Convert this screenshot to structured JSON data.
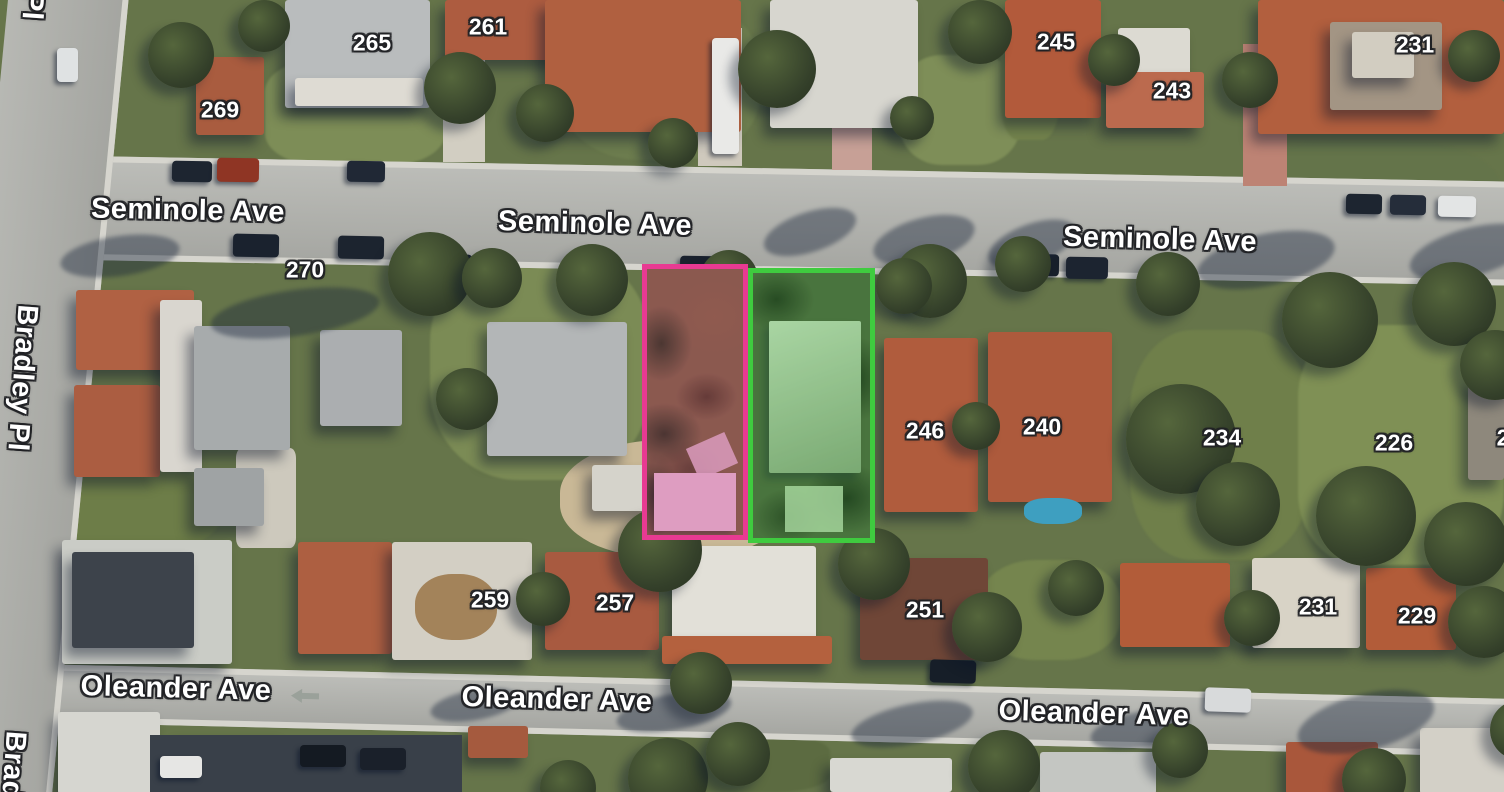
{
  "map": {
    "view": "satellite",
    "streets": {
      "seminole_ave": "Seminole Ave",
      "oleander_ave": "Oleander Ave",
      "bradley_pl": "Bradley Pl",
      "bradley_pl_partial_top": "Pl",
      "bradley_pl_partial_bottom": "Brad"
    },
    "house_numbers": {
      "north_row": [
        "269",
        "265",
        "261",
        "245",
        "243",
        "231"
      ],
      "middle_row": [
        "270",
        "246",
        "240",
        "234",
        "226",
        "2"
      ],
      "south_row": [
        "259",
        "257",
        "251",
        "231",
        "229"
      ]
    },
    "parcels": {
      "pink": {
        "outline_color": "#e83a92"
      },
      "green": {
        "outline_color": "#3fcb3f"
      }
    },
    "road_markings": {
      "one_way_arrow_direction": "left"
    }
  }
}
